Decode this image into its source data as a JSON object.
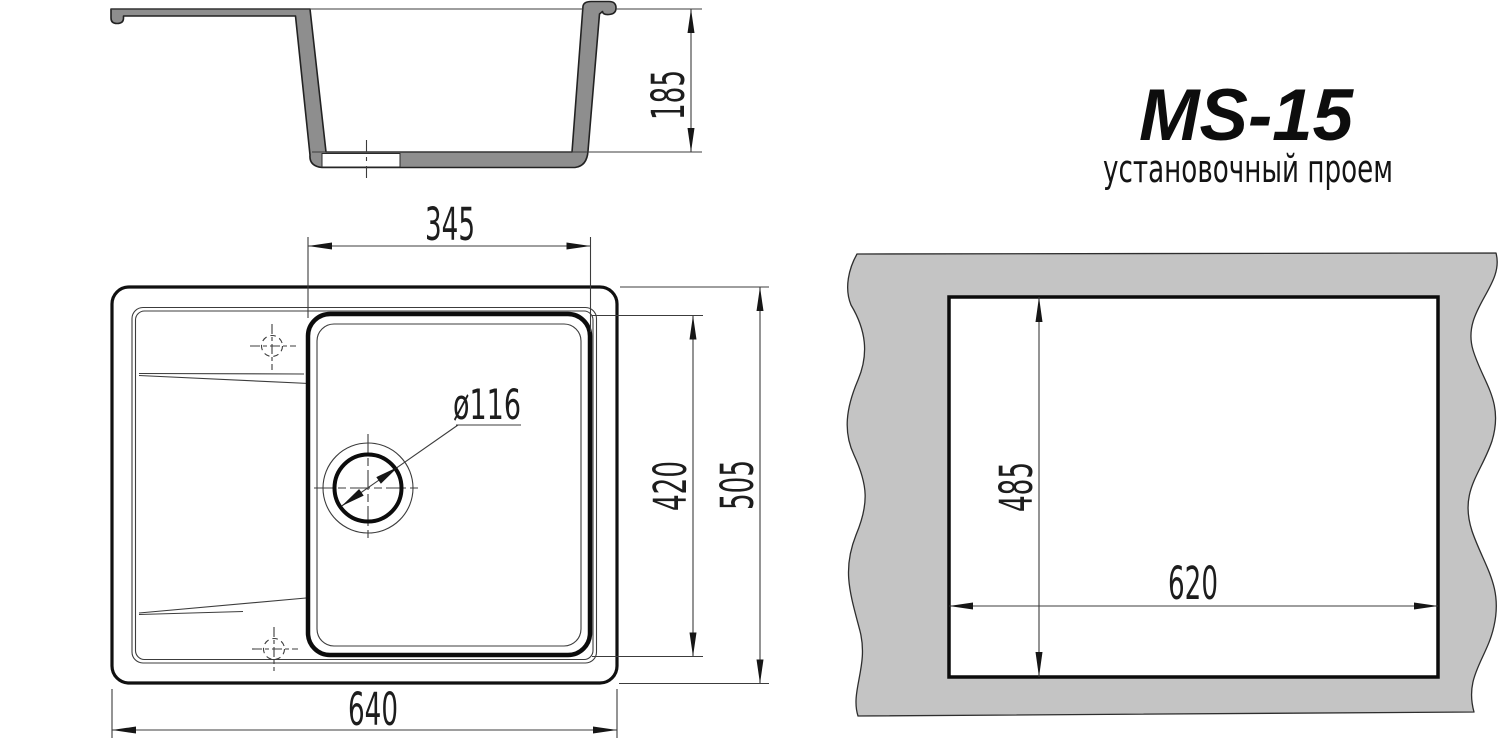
{
  "title": {
    "model": "MS-15",
    "subtitle": "установочный проем"
  },
  "section_view": {
    "depth": "185"
  },
  "plan_view": {
    "bowl_width": "345",
    "bowl_depth": "420",
    "overall_depth": "505",
    "overall_width": "640",
    "drain_diameter": "ø116"
  },
  "cutout_view": {
    "opening_depth": "485",
    "opening_width": "620"
  },
  "colors": {
    "section_fill": "#8e8e8e",
    "panel_fill": "#c4c4c4",
    "line_dark": "#161616",
    "background": "#ffffff"
  }
}
